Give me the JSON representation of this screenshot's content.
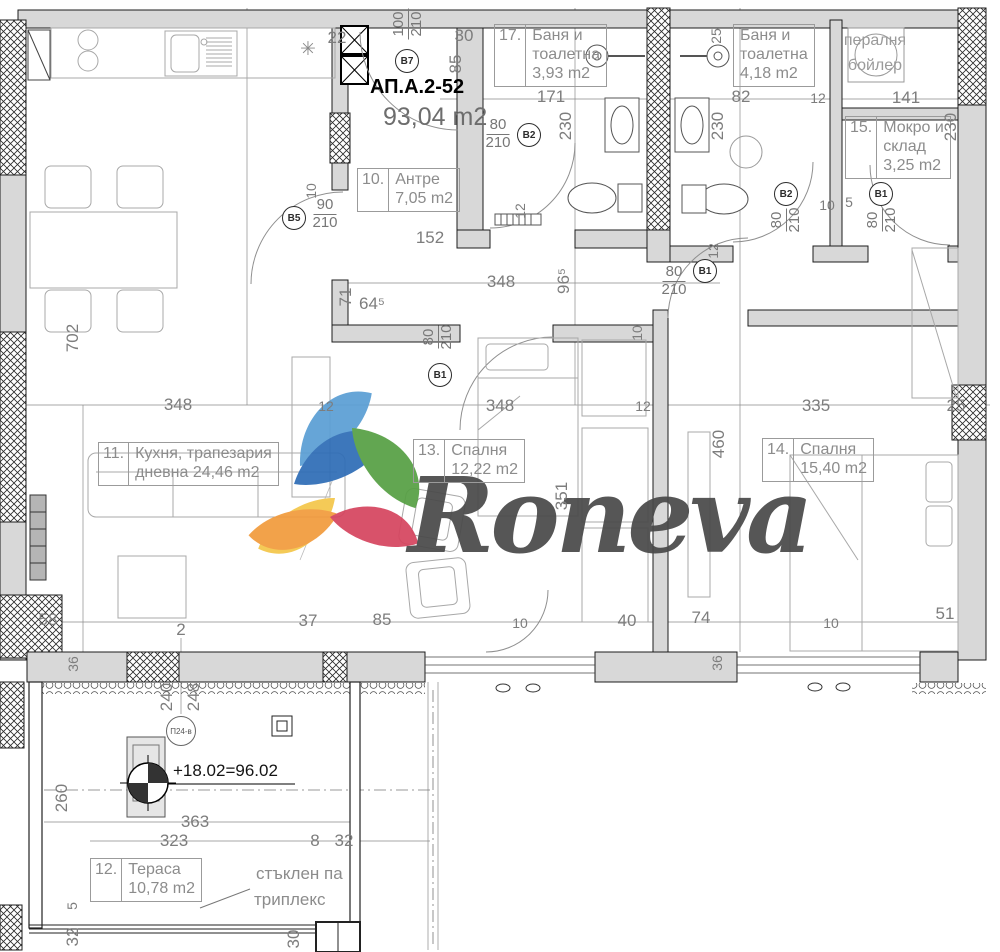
{
  "header": {
    "plan_id": "АП.А.2-52",
    "total_area": "93,04 m2"
  },
  "logo": {
    "brand": "Roneva"
  },
  "rooms": [
    {
      "num": "10.",
      "line1": "Антре",
      "line2": "7,05 m2"
    },
    {
      "num": "17.",
      "line1": "Баня и",
      "line2": "тоалетна",
      "line3": "3,93 m2"
    },
    {
      "num": "",
      "line1": "Баня и",
      "line2": "тоалетна",
      "line3": "4,18 m2"
    },
    {
      "num": "15.",
      "line1": "Мокро и",
      "line2": "склад",
      "line3": "3,25 m2"
    },
    {
      "num": "11.",
      "line1": "Кухня, трапезария",
      "line2": "дневна 24,46 m2"
    },
    {
      "num": "13.",
      "line1": "Спалня",
      "line2": "12,22 m2"
    },
    {
      "num": "14.",
      "line1": "Спалня",
      "line2": "15,40 m2"
    },
    {
      "num": "12.",
      "line1": "Тераса",
      "line2": "10,78 m2"
    }
  ],
  "doors": [
    {
      "id": "В7",
      "w": "100",
      "h": "210"
    },
    {
      "id": "В5",
      "w": "90",
      "h": "210"
    },
    {
      "id": "В2",
      "w": "80",
      "h": "210"
    },
    {
      "id": "В2",
      "w": "80",
      "h": "210"
    },
    {
      "id": "В1",
      "w": "80",
      "h": "210"
    },
    {
      "id": "В1",
      "w": "80",
      "h": "210"
    },
    {
      "id": "В1",
      "w": "80",
      "h": "210"
    }
  ],
  "notes": {
    "laundry1": "пералня",
    "laundry2": "бойлер",
    "glass1": "стъклен па",
    "glass2": "триплекс",
    "elevation": "+18.02=96.02",
    "window_mark": "П24-в",
    "asterisk": "✳"
  },
  "dims": [
    "30",
    "85",
    "171",
    "82",
    "12",
    "141",
    "230",
    "230",
    "230",
    "12",
    "12",
    "152",
    "348",
    "96⁵",
    "64⁵",
    "71",
    "10",
    "348",
    "12",
    "348",
    "12",
    "335",
    "25",
    "702",
    "460",
    "351",
    "58",
    "2",
    "37",
    "85",
    "10",
    "40",
    "74",
    "10",
    "51",
    "36",
    "36",
    "240",
    "248",
    "260",
    "363",
    "323",
    "8",
    "32",
    "5",
    "32",
    "30",
    "22",
    "10",
    "25",
    "10",
    "5"
  ]
}
